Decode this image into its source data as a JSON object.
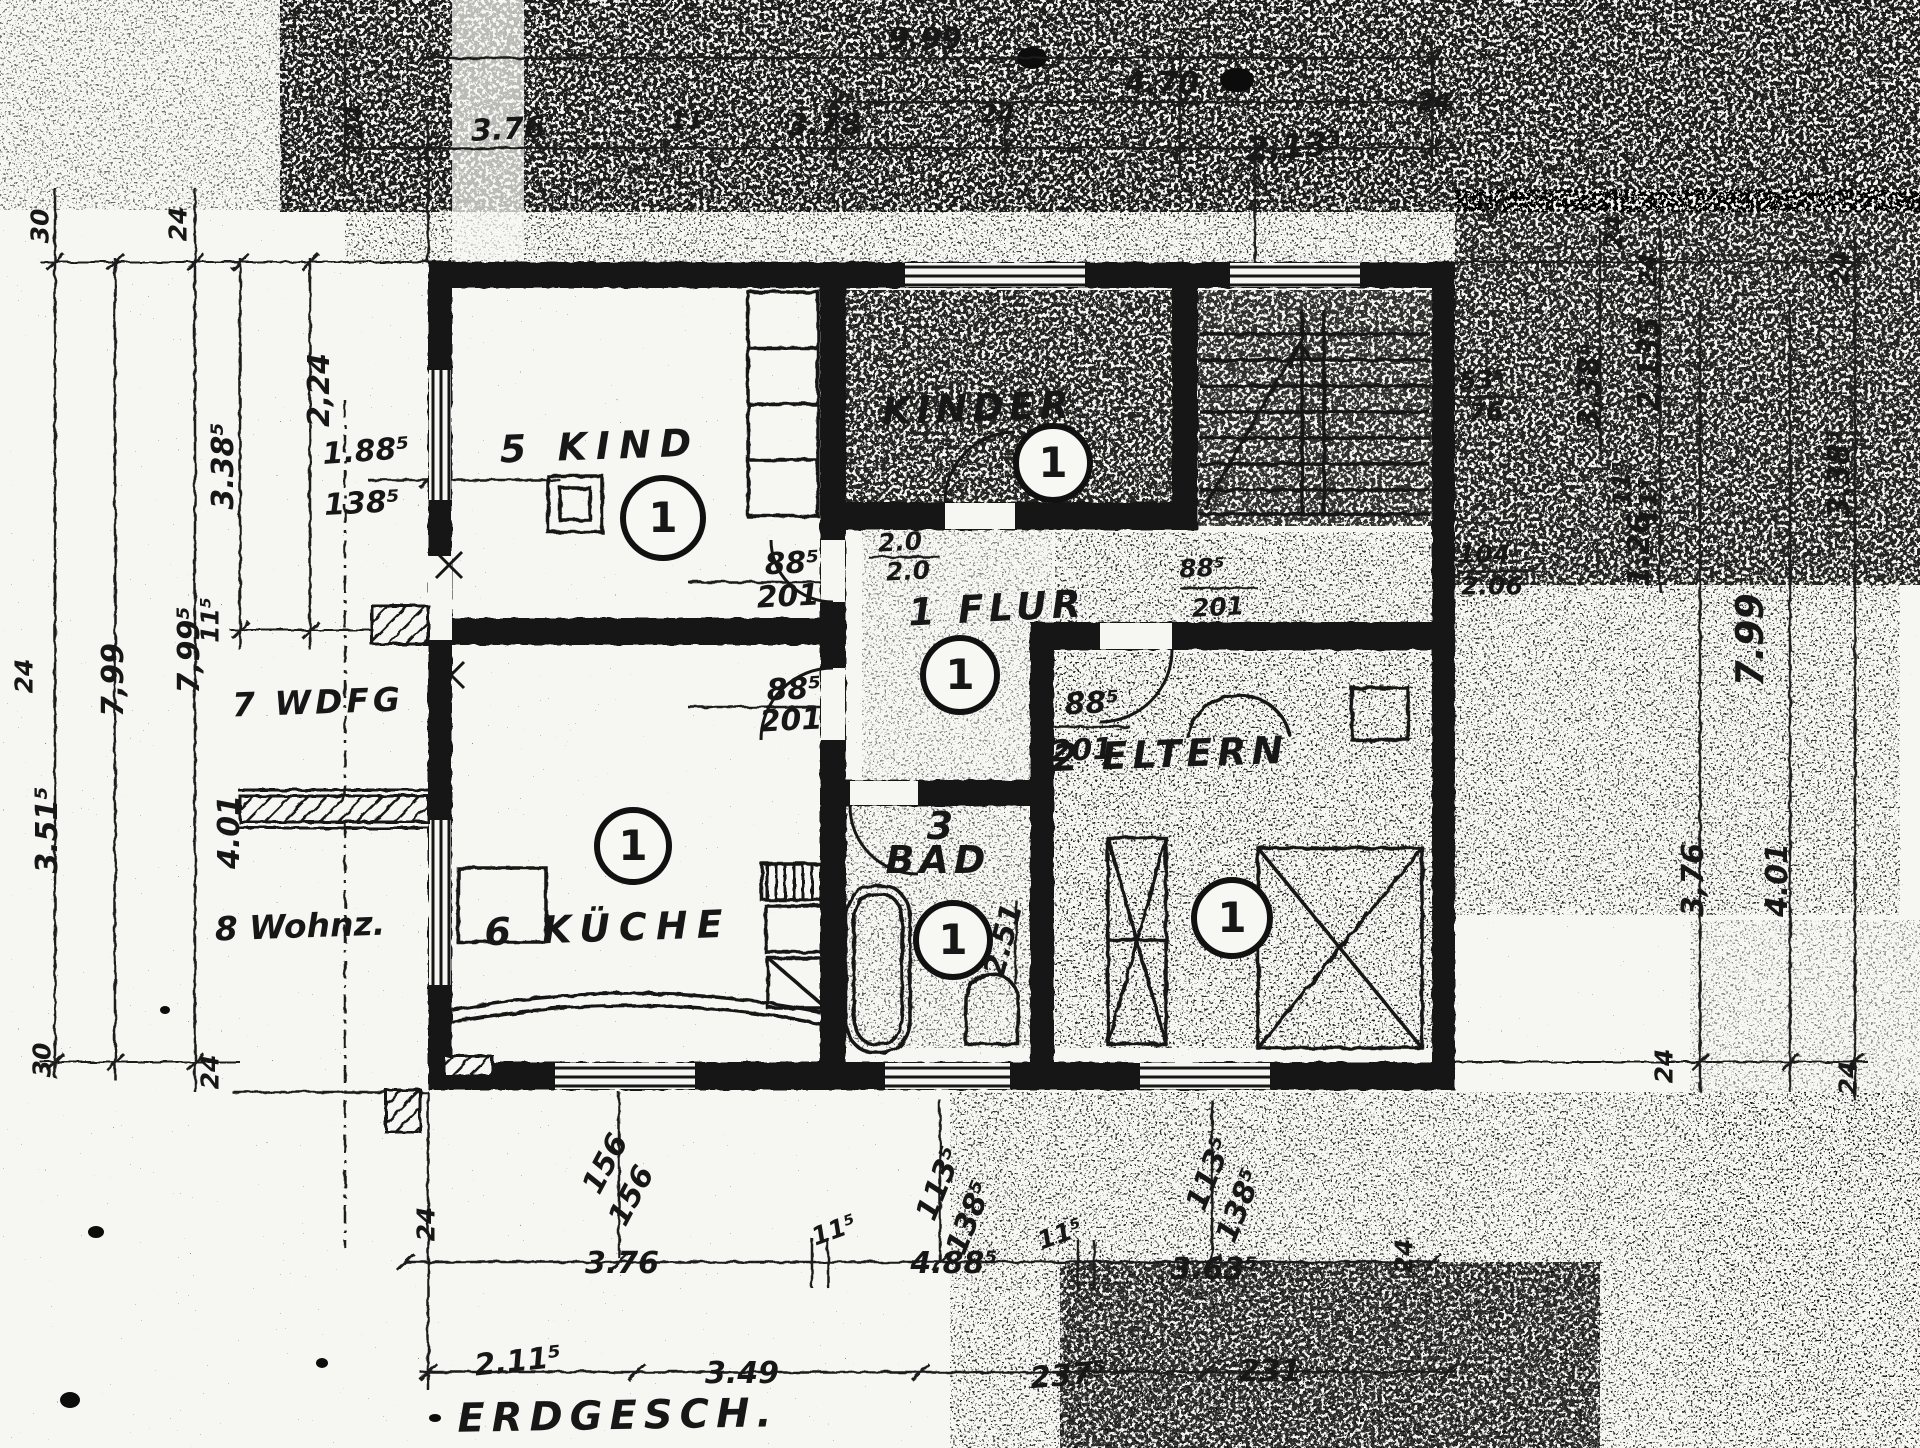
{
  "title": "ERDGESCH.",
  "plan": {
    "kind": "5 KIND",
    "kinder": "KINDER",
    "flur": "1 FLUR",
    "eltern": "2 ELTERN",
    "bad_no": "3",
    "bad": "BAD",
    "kueche": "6 KÜCHE",
    "wdfg": "7 WDFG",
    "wohnz": "8 Wohnz.",
    "one": "1",
    "d885": "88⁵",
    "d201": "201",
    "d20": "2.0",
    "d251": "2.51"
  },
  "top": {
    "d999": "9.99",
    "d470": "4.70",
    "d376": "3.76",
    "d115": "11⁵",
    "d378": "3.78",
    "d24": "24",
    "d2135": "2,13⁵"
  },
  "left": {
    "d30": "30",
    "d24": "24",
    "d224": "2,24",
    "d3385": "3.38⁵",
    "d1885": "1.88⁵",
    "d1385": "138⁵",
    "d799": "7,99",
    "d115": "11⁵",
    "d7995": "7,99⁵",
    "d3515": "3.51⁵",
    "d401": "4.01"
  },
  "right": {
    "d24": "24",
    "d3385": "3,38⁵",
    "d2135": "2,135",
    "d115": "11⁵",
    "d126": "1.26",
    "d535": "53⁵",
    "d76": "76",
    "d104": "104",
    "d206": "2.06",
    "d799": "7.99",
    "d376": "3,76",
    "d401": "4.01"
  },
  "bottom": {
    "d156": "156",
    "d1135": "113⁵",
    "d1385": "138⁵",
    "d24": "24",
    "d376": "3.76",
    "d115": "11⁵",
    "d4885": "4.88⁵",
    "d3635": "3.63⁵",
    "d2115": "2.11⁵",
    "d349": "3.49",
    "d2375": "237⁵",
    "d231": "231"
  }
}
